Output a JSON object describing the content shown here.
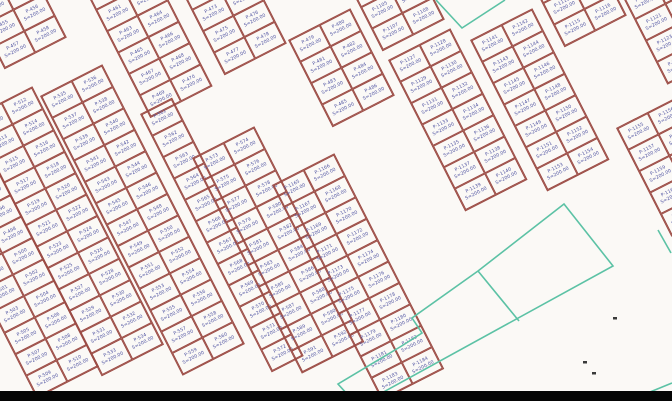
{
  "map": {
    "background_color": "#fbf9f6",
    "parcel_border_color": "#9b4a43",
    "parcel_text_color": "#5054a2",
    "boundary_color": "#5cc2a5",
    "speck_color": "#3a3a3a",
    "letterbox_color": "#050505",
    "area_label": "S=200.00",
    "rotation_deg": -27,
    "cell": {
      "w": 34,
      "h": 24
    },
    "blocks": [
      {
        "name": "block-top-left-corner",
        "x": -40,
        "y": -18,
        "cols": 2,
        "rows": 4,
        "ids": [
          "P-451",
          "P-452",
          "P-453",
          "P-454",
          "P-455",
          "P-456",
          "P-457",
          "P-458"
        ]
      },
      {
        "name": "block-top-strip-a",
        "x": 84,
        "y": -12,
        "cols": 2,
        "rows": 6,
        "ids": [
          "P-459",
          "P-460",
          "P-461",
          "P-462",
          "P-463",
          "P-464",
          "P-465",
          "P-466",
          "P-467",
          "P-468",
          "P-469",
          "P-470"
        ]
      },
      {
        "name": "block-top-strip-b",
        "x": 180,
        "y": -12,
        "cols": 2,
        "rows": 4,
        "ids": [
          "P-471",
          "P-472",
          "P-473",
          "P-474",
          "P-475",
          "P-476",
          "P-477",
          "P-478"
        ]
      },
      {
        "name": "block-top-mid",
        "x": 288,
        "y": 40,
        "cols": 2,
        "rows": 4,
        "ids": [
          "P-479",
          "P-480",
          "P-481",
          "P-482",
          "P-483",
          "P-484",
          "P-485",
          "P-486"
        ]
      },
      {
        "name": "block-top-right-a",
        "x": 338,
        "y": -36,
        "cols": 2,
        "rows": 4,
        "ids": [
          "P-1101",
          "P-1102",
          "P-1103",
          "P-1104",
          "P-1105",
          "P-1106",
          "P-1107",
          "P-1108"
        ]
      },
      {
        "name": "block-top-right-b",
        "x": 520,
        "y": -40,
        "cols": 2,
        "rows": 4,
        "ids": [
          "P-1109",
          "P-1110",
          "P-1111",
          "P-1112",
          "P-1113",
          "P-1114",
          "P-1115",
          "P-1116"
        ]
      },
      {
        "name": "block-top-right-c",
        "x": 612,
        "y": -24,
        "cols": 2,
        "rows": 5,
        "ids": [
          "P-1117",
          "P-1118",
          "P-1119",
          "P-1120",
          "P-1121",
          "P-1122",
          "P-1123",
          "P-1124",
          "P-1125",
          "P-1126"
        ]
      },
      {
        "name": "block-mid-right-a",
        "x": 388,
        "y": 60,
        "cols": 2,
        "rows": 7,
        "ids": [
          "P-1127",
          "P-1128",
          "P-1129",
          "P-1130",
          "P-1131",
          "P-1132",
          "P-1133",
          "P-1134",
          "P-1135",
          "P-1136",
          "P-1137",
          "P-1138",
          "P-1139",
          "P-1140"
        ]
      },
      {
        "name": "block-mid-right-b",
        "x": 470,
        "y": 40,
        "cols": 2,
        "rows": 7,
        "ids": [
          "P-1141",
          "P-1142",
          "P-1143",
          "P-1144",
          "P-1145",
          "P-1146",
          "P-1147",
          "P-1148",
          "P-1149",
          "P-1150",
          "P-1151",
          "P-1152",
          "P-1153",
          "P-1154"
        ]
      },
      {
        "name": "block-right-edge",
        "x": 616,
        "y": 128,
        "cols": 2,
        "rows": 5,
        "ids": [
          "P-1155",
          "P-1156",
          "P-1157",
          "P-1158",
          "P-1159",
          "P-1160",
          "P-1161",
          "P-1162",
          "P-1163",
          "P-1164"
        ]
      },
      {
        "name": "block-left-a",
        "x": -95,
        "y": 140,
        "cols": 2,
        "rows": 12,
        "ids": [
          "P-487",
          "P-488",
          "P-489",
          "P-490",
          "P-491",
          "P-492",
          "P-493",
          "P-494",
          "P-495",
          "P-496",
          "P-497",
          "P-498",
          "P-499",
          "P-500",
          "P-501",
          "P-502",
          "P-503",
          "P-504",
          "P-505",
          "P-506",
          "P-507",
          "P-508",
          "P-509",
          "P-510"
        ]
      },
      {
        "name": "block-left-b",
        "x": -30,
        "y": 118,
        "cols": 2,
        "rows": 12,
        "ids": [
          "P-511",
          "P-512",
          "P-513",
          "P-514",
          "P-515",
          "P-516",
          "P-517",
          "P-518",
          "P-519",
          "P-520",
          "P-521",
          "P-522",
          "P-523",
          "P-524",
          "P-525",
          "P-526",
          "P-527",
          "P-528",
          "P-529",
          "P-530",
          "P-531",
          "P-532",
          "P-533",
          "P-534"
        ]
      },
      {
        "name": "block-left-c",
        "x": 40,
        "y": 96,
        "cols": 2,
        "rows": 13,
        "ids": [
          "P-535",
          "P-536",
          "P-537",
          "P-538",
          "P-539",
          "P-540",
          "P-541",
          "P-542",
          "P-543",
          "P-544",
          "P-545",
          "P-546",
          "P-547",
          "P-548",
          "P-549",
          "P-550",
          "P-551",
          "P-552",
          "P-553",
          "P-554",
          "P-555",
          "P-556",
          "P-557",
          "P-558",
          "P-559",
          "P-560"
        ]
      },
      {
        "name": "block-single-strip",
        "x": 140,
        "y": 114,
        "cols": 1,
        "rows": 12,
        "ids": [
          "P-561",
          "P-562",
          "P-563",
          "P-564",
          "P-565",
          "P-566",
          "P-567",
          "P-568",
          "P-569",
          "P-570",
          "P-571",
          "P-572"
        ]
      },
      {
        "name": "block-bottom-mid-a",
        "x": 192,
        "y": 158,
        "cols": 2,
        "rows": 10,
        "ids": [
          "P-573",
          "P-574",
          "P-575",
          "P-576",
          "P-577",
          "P-578",
          "P-579",
          "P-580",
          "P-581",
          "P-582",
          "P-583",
          "P-584",
          "P-585",
          "P-586",
          "P-587",
          "P-588",
          "P-589",
          "P-590",
          "P-591",
          "P-592"
        ]
      },
      {
        "name": "block-bottom-mid-b",
        "x": 272,
        "y": 185,
        "cols": 2,
        "rows": 10,
        "ids": [
          "P-1165",
          "P-1166",
          "P-1167",
          "P-1168",
          "P-1169",
          "P-1170",
          "P-1171",
          "P-1172",
          "P-1173",
          "P-1174",
          "P-1175",
          "P-1176",
          "P-1177",
          "P-1178",
          "P-1179",
          "P-1180",
          "P-1181",
          "P-1182",
          "P-1183",
          "P-1184"
        ]
      }
    ],
    "boundary": {
      "outer_polygon": "564,204 613,266 358,406 338,384 400,347 422,333 412,318 478,271",
      "divider_line": [
        478,
        271,
        519,
        321
      ],
      "corner_v": "436,0 462,28 505,0",
      "fragment_right": [
        658,
        230,
        671,
        253
      ],
      "fragment_bottom_right": [
        650,
        392,
        672,
        383
      ]
    },
    "specks": [
      [
        613,
        317
      ],
      [
        583,
        361
      ],
      [
        592,
        372
      ]
    ]
  }
}
